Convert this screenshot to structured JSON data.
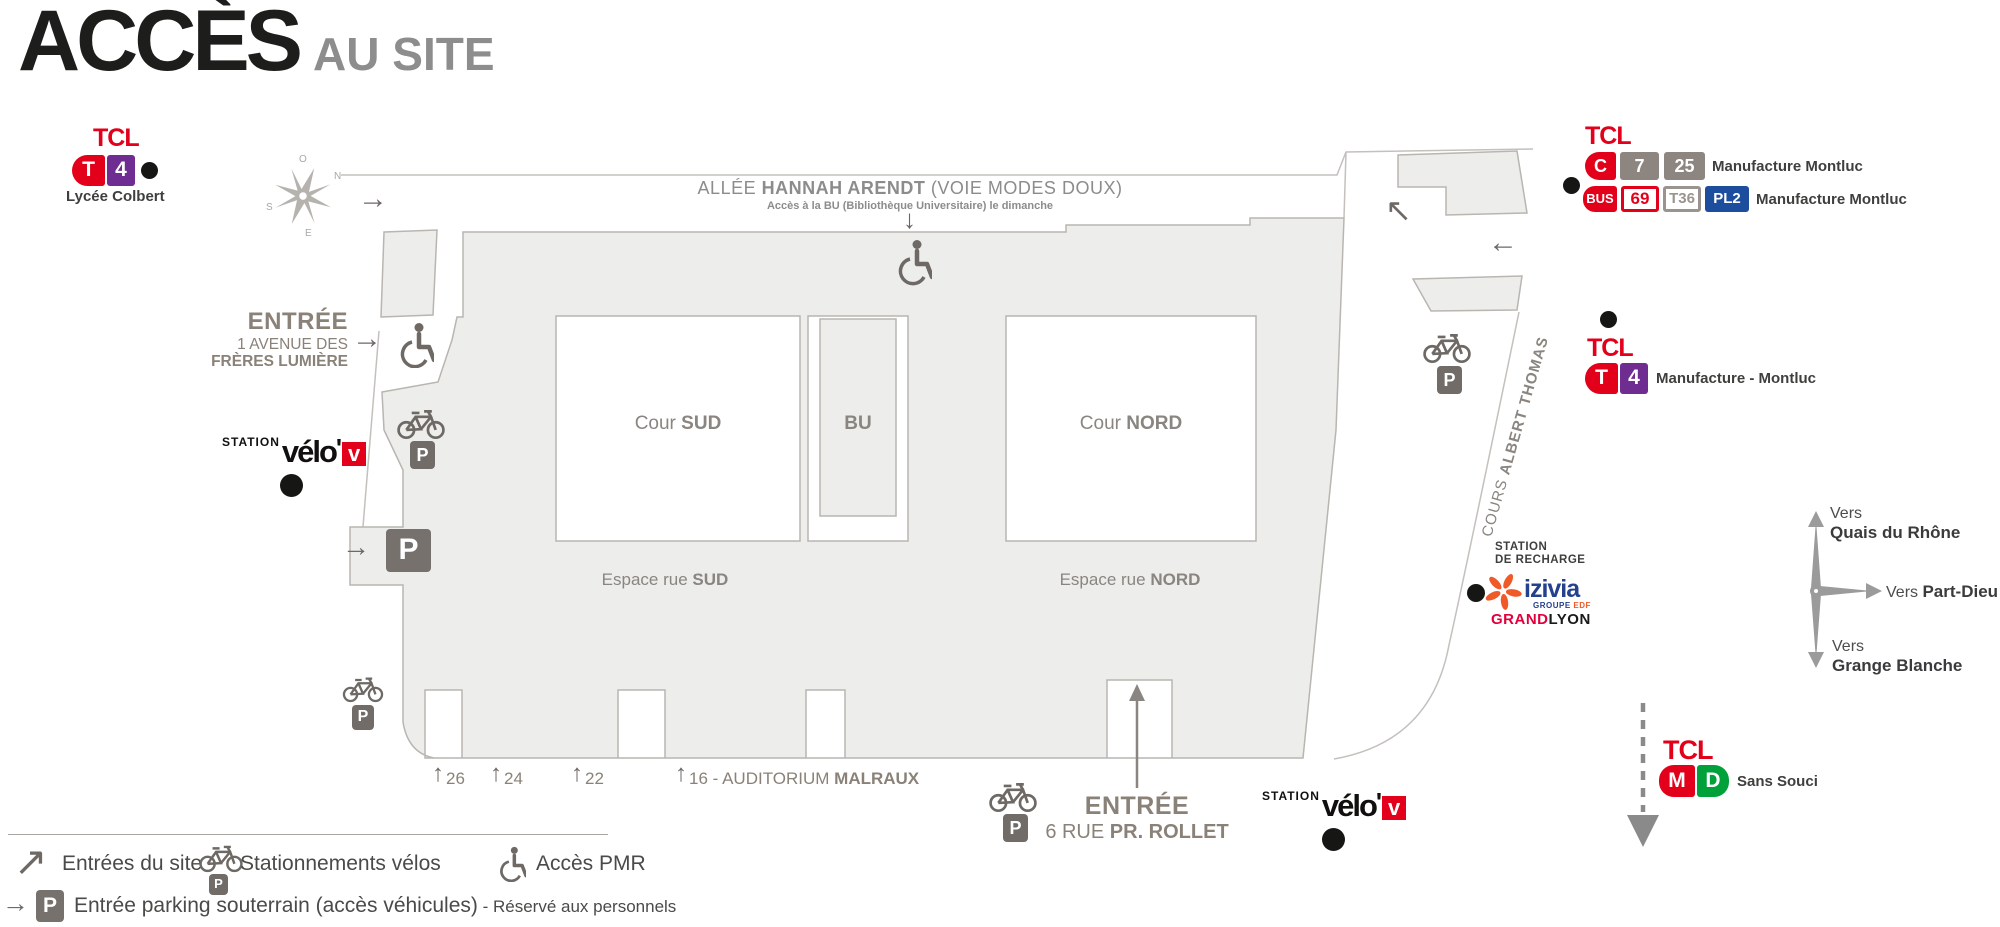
{
  "title": {
    "main": "ACCÈS",
    "sub": "AU SITE"
  },
  "colors": {
    "tcl_red": "#e2001a",
    "tram_purple": "#6f2c91",
    "badge_gray": "#8d8680",
    "bus_blue": "#1d4e9e",
    "metro_green": "#00a13a",
    "map_fill": "#ededec",
    "map_stroke": "#b9b5b1",
    "icon_gray": "#6e6965",
    "warm_gray_text": "#8a8278",
    "dark_text": "#3f3f3d",
    "izivia_blue": "#24418e",
    "izivia_orange": "#f05a28",
    "grand_red": "#e2003c"
  },
  "icons": {
    "arrow_right": "→",
    "arrow_left": "←",
    "arrow_up": "↑",
    "arrow_down": "↓",
    "arrow_up_left": "↖",
    "arrow_up_right": "↗",
    "p": "P"
  },
  "compass": {
    "o": "O",
    "n": "N",
    "e": "E",
    "s": "S"
  },
  "tcl_t4_colbert": {
    "brand": "TCL",
    "badges": [
      "T",
      "4"
    ],
    "stop": "Lycée Colbert"
  },
  "allee": {
    "pre": "ALLÉE ",
    "name": "HANNAH ARENDT",
    "post": " (VOIE MODES DOUX)",
    "note": "Accès à la BU (Bibliothèque Universitaire) le dimanche"
  },
  "entree_lumiere": {
    "title": "ENTRÉE",
    "line1": "1 AVENUE DES",
    "line2": "FRÈRES LUMIÈRE"
  },
  "velov": {
    "station": "STATION",
    "word": "vélo",
    "apos": "'",
    "v": "v"
  },
  "map": {
    "cour_sud_pre": "Cour ",
    "cour_sud_bold": "SUD",
    "bu": "BU",
    "cour_nord_pre": "Cour ",
    "cour_nord_bold": "NORD",
    "espace_pre": "Espace rue ",
    "espace_sud_bold": "SUD",
    "espace_nord_bold": "NORD",
    "street_pre": "COURS ",
    "street_bold": "ALBERT THOMAS"
  },
  "tcl_right_top": {
    "brand": "TCL",
    "row1": {
      "badges": [
        "C",
        "7",
        "25"
      ],
      "stop": "Manufacture Montluc"
    },
    "row2": {
      "badges": [
        "BUS",
        "69",
        "T36",
        "PL2"
      ],
      "stop": "Manufacture Montluc"
    }
  },
  "tcl_t4_montluc": {
    "brand": "TCL",
    "badges": [
      "T",
      "4"
    ],
    "stop": "Manufacture - Montluc"
  },
  "recharge": {
    "line1": "STATION",
    "line2": "DE RECHARGE",
    "brand": "izivia",
    "sub_pre": "GROUPE ",
    "sub_bold": "EDF",
    "city_red": "GRAND",
    "city_black": "LYON"
  },
  "directions": {
    "up_pre": "Vers",
    "up_bold": "Quais du Rhône",
    "right_pre": "Vers ",
    "right_bold": "Part-Dieu",
    "down_pre": "Vers",
    "down_bold": "Grange Blanche"
  },
  "tcl_metro": {
    "brand": "TCL",
    "badges": [
      "M",
      "D"
    ],
    "stop": "Sans Souci"
  },
  "bottom": {
    "n26": "26",
    "n24": "24",
    "n22": "22",
    "n16_pre": "16 - AUDITORIUM ",
    "n16_bold": "MALRAUX",
    "entree": "ENTRÉE",
    "rue_pre": "6 RUE ",
    "rue_bold": "PR. ROLLET"
  },
  "legend": {
    "entrees": "Entrées du site",
    "velos": "Stationnements vélos",
    "pmr": "Accès PMR",
    "parking": "Entrée parking souterrain (accès véhicules)",
    "parking_note": " - Réservé aux personnels"
  }
}
